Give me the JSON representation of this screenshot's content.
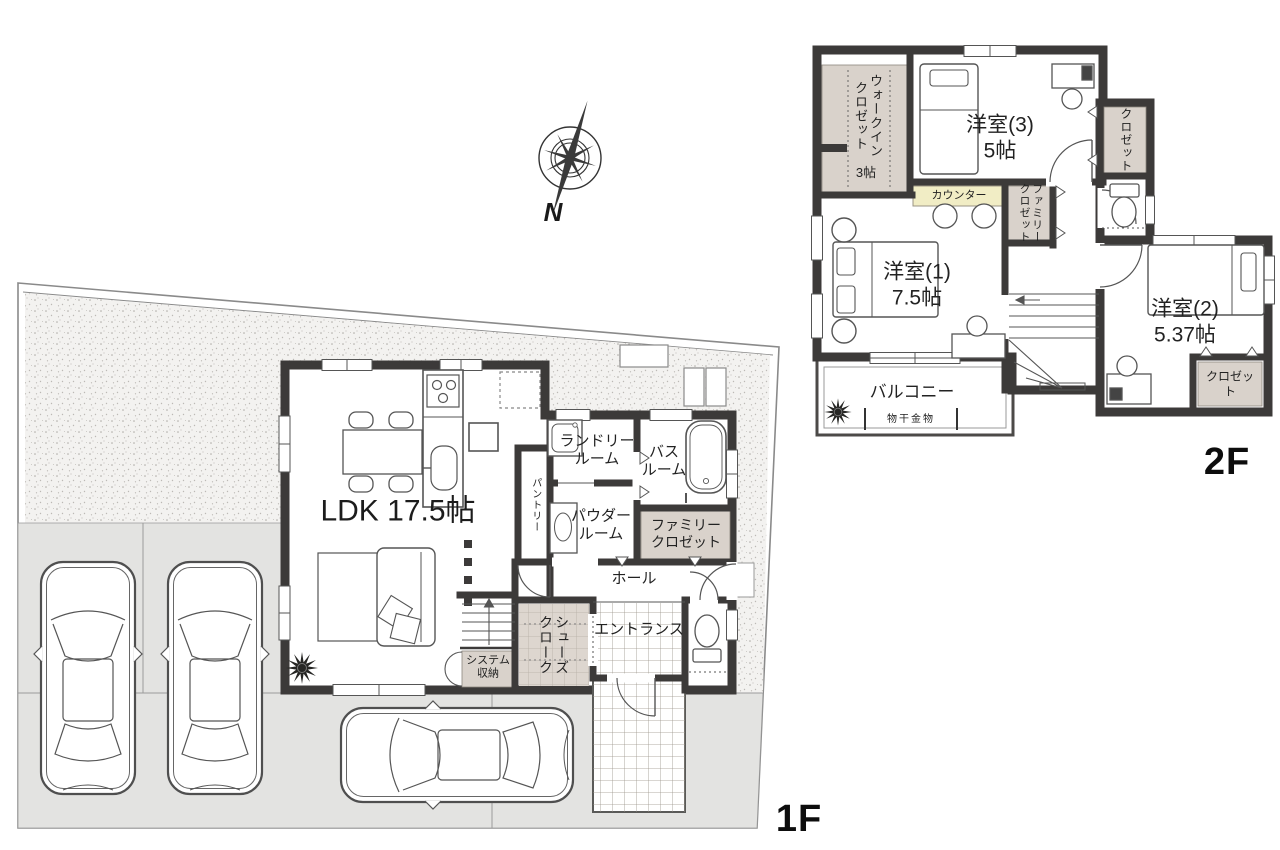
{
  "compass": {
    "north_label": "N"
  },
  "floor_1f": {
    "tag": "1F",
    "rooms": {
      "ldk": "LDK 17.5帖",
      "laundry_room": "ランドリー\nルーム",
      "bath_room": "バス\nルーム",
      "powder_room": "パウダー\nルーム",
      "pantry": "パントリー",
      "family_closet": "ファミリー\nクロゼット",
      "hall": "ホール",
      "entrance": "エントランス",
      "shoes_cloak": "シューズ\nクローク",
      "system_storage": "システム\n収納"
    }
  },
  "floor_2f": {
    "tag": "2F",
    "rooms": {
      "walk_in_closet": "ウォークイン\nクロゼット",
      "walk_in_closet_size": "3帖",
      "western_room_3": "洋室(3)\n5帖",
      "closet_upper": "クロゼット",
      "counter": "カウンター",
      "family_closet": "ファミリー\nクロゼット",
      "western_room_1": "洋室(1)\n7.5帖",
      "western_room_2": "洋室(2)\n5.37帖",
      "closet_lower": "クロゼット",
      "balcony": "バルコニー",
      "drying_fixture": "物干金物"
    }
  },
  "colors": {
    "wall": "#3c3a39",
    "closet_fill": "#d9d2cb",
    "counter_fill": "#f1edc5",
    "driveway_fill": "#e3e3e1",
    "floor_fill": "#ffffff"
  }
}
